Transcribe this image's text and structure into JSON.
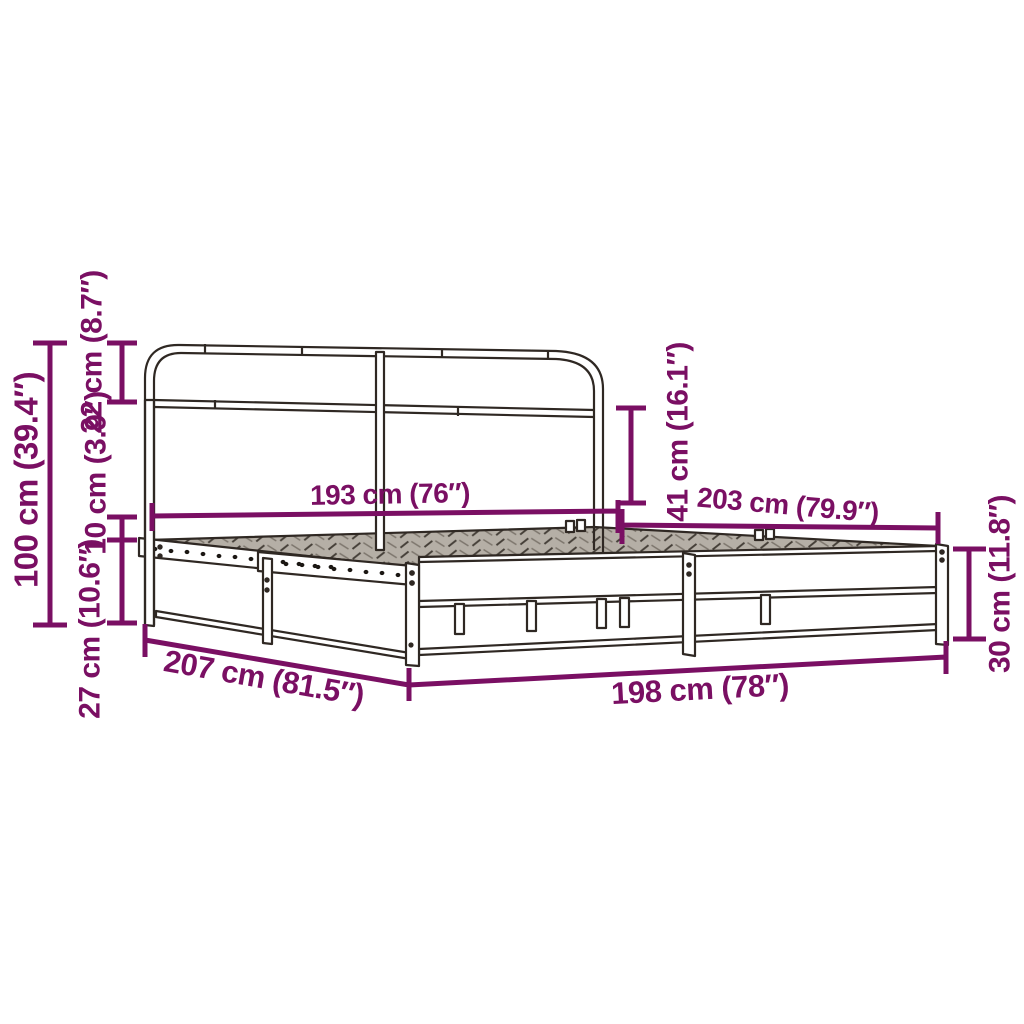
{
  "diagram": {
    "title": "metal-bed-frame-dimension-diagram",
    "colors": {
      "dimension": "#7a0f63",
      "frame": "#2f2823",
      "background": "#ffffff",
      "mesh_fill": "#b5afa6",
      "mesh_hatch": "#453f38",
      "mesh_hatch_light": "#7d766d"
    },
    "dimensions": {
      "total_height": {
        "label": "100 cm (39.4″)",
        "cm": 100,
        "inches": 39.4
      },
      "headboard_top": {
        "label": "22 cm (8.7″)",
        "cm": 22,
        "inches": 8.7
      },
      "rail_height": {
        "label": "10 cm (3.9″)",
        "cm": 10,
        "inches": 3.9
      },
      "under_bed_clearance": {
        "label": "27 cm (10.6″)",
        "cm": 27,
        "inches": 10.6
      },
      "headboard_width": {
        "label": "193 cm (76″)",
        "cm": 193,
        "inches": 76
      },
      "headboard_above_deck": {
        "label": "41 cm (16.1″)",
        "cm": 41,
        "inches": 16.1
      },
      "inner_length": {
        "label": "203 cm (79.9″)",
        "cm": 203,
        "inches": 79.9
      },
      "footboard_height": {
        "label": "30 cm (11.8″)",
        "cm": 30,
        "inches": 11.8
      },
      "total_length": {
        "label": "207 cm (81.5″)",
        "cm": 207,
        "inches": 81.5
      },
      "total_width": {
        "label": "198 cm (78″)",
        "cm": 198,
        "inches": 78
      }
    }
  }
}
